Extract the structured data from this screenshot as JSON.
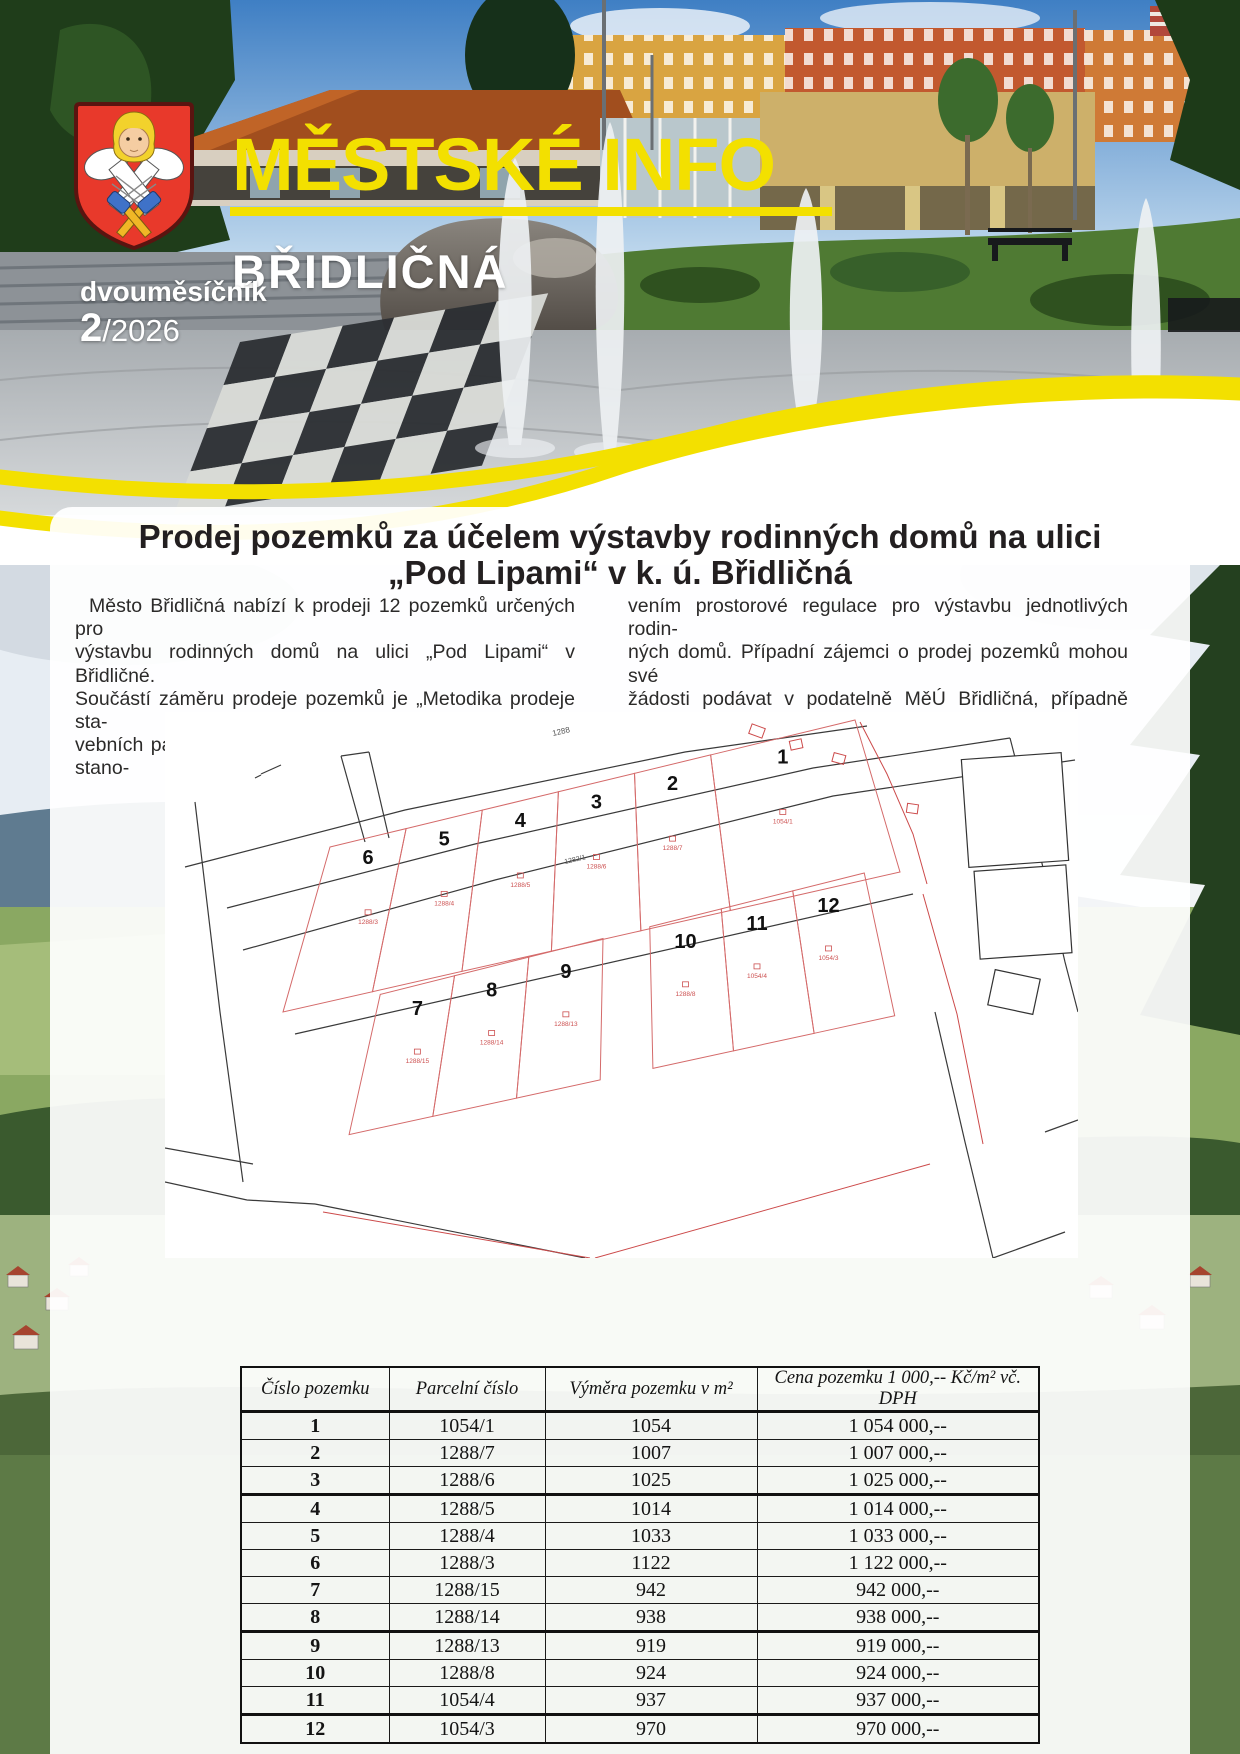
{
  "colors": {
    "brand_yellow": "#f3e000",
    "shield_red": "#e63c2f",
    "text_dark": "#231f20",
    "map_parcel_red": "#cc5050"
  },
  "masthead": {
    "title": "MĚSTSKÉ INFO",
    "town": "BŘIDLIČNÁ",
    "periodicity": "dvouměsíčník",
    "issue_number": "2",
    "issue_year": "/2026"
  },
  "article": {
    "title_line1": "Prodej pozemků za účelem výstavby rodinných domů na ulici",
    "title_line2": "„Pod Lipami“ v k. ú. Břidličná",
    "col1_lines": [
      "Město Břidličná nabízí k prodeji 12 pozemků určených pro",
      "výstavbu rodinných domů na ulici „Pod Lipami“ v Břidličné.",
      "Součástí záměru prodeje pozemků je „Metodika prodeje sta-",
      "vebních parcel“, vč. žádosti o prodej a územní studie se stano-"
    ],
    "col2_lines": [
      "vením prostorové regulace pro výstavbu jednotlivých rodin-",
      "ných domů. Případní zájemci o prodej pozemků mohou své",
      "žádosti podávat v podatelně MěÚ Břidličná, případně přímo",
      "v kanceláři vedoucí odboru HS Bc. M. Kováčové."
    ]
  },
  "map": {
    "road_label": "1288",
    "secondary_label": "1282/1",
    "plots": [
      {
        "number": "1",
        "parcel": "1054/1"
      },
      {
        "number": "2",
        "parcel": "1288/7"
      },
      {
        "number": "3",
        "parcel": "1288/6"
      },
      {
        "number": "4",
        "parcel": "1288/5"
      },
      {
        "number": "5",
        "parcel": "1288/4"
      },
      {
        "number": "6",
        "parcel": "1288/3"
      },
      {
        "number": "7",
        "parcel": "1288/15"
      },
      {
        "number": "8",
        "parcel": "1288/14"
      },
      {
        "number": "9",
        "parcel": "1288/13"
      },
      {
        "number": "10",
        "parcel": "1288/8"
      },
      {
        "number": "11",
        "parcel": "1054/4"
      },
      {
        "number": "12",
        "parcel": "1054/3"
      }
    ]
  },
  "table": {
    "headers": [
      "Číslo pozemku",
      "Parcelní číslo",
      "Výměra pozemku v m²",
      "Cena pozemku 1 000,-- Kč/m² vč. DPH"
    ],
    "rows": [
      [
        "1",
        "1054/1",
        "1054",
        "1 054 000,--"
      ],
      [
        "2",
        "1288/7",
        "1007",
        "1 007 000,--"
      ],
      [
        "3",
        "1288/6",
        "1025",
        "1 025 000,--"
      ],
      [
        "4",
        "1288/5",
        "1014",
        "1 014 000,--"
      ],
      [
        "5",
        "1288/4",
        "1033",
        "1 033 000,--"
      ],
      [
        "6",
        "1288/3",
        "1122",
        "1 122 000,--"
      ],
      [
        "7",
        "1288/15",
        "942",
        "942 000,--"
      ],
      [
        "8",
        "1288/14",
        "938",
        "938 000,--"
      ],
      [
        "9",
        "1288/13",
        "919",
        "919 000,--"
      ],
      [
        "10",
        "1288/8",
        "924",
        "924 000,--"
      ],
      [
        "11",
        "1054/4",
        "937",
        "937 000,--"
      ],
      [
        "12",
        "1054/3",
        "970",
        "970 000,--"
      ]
    ]
  }
}
